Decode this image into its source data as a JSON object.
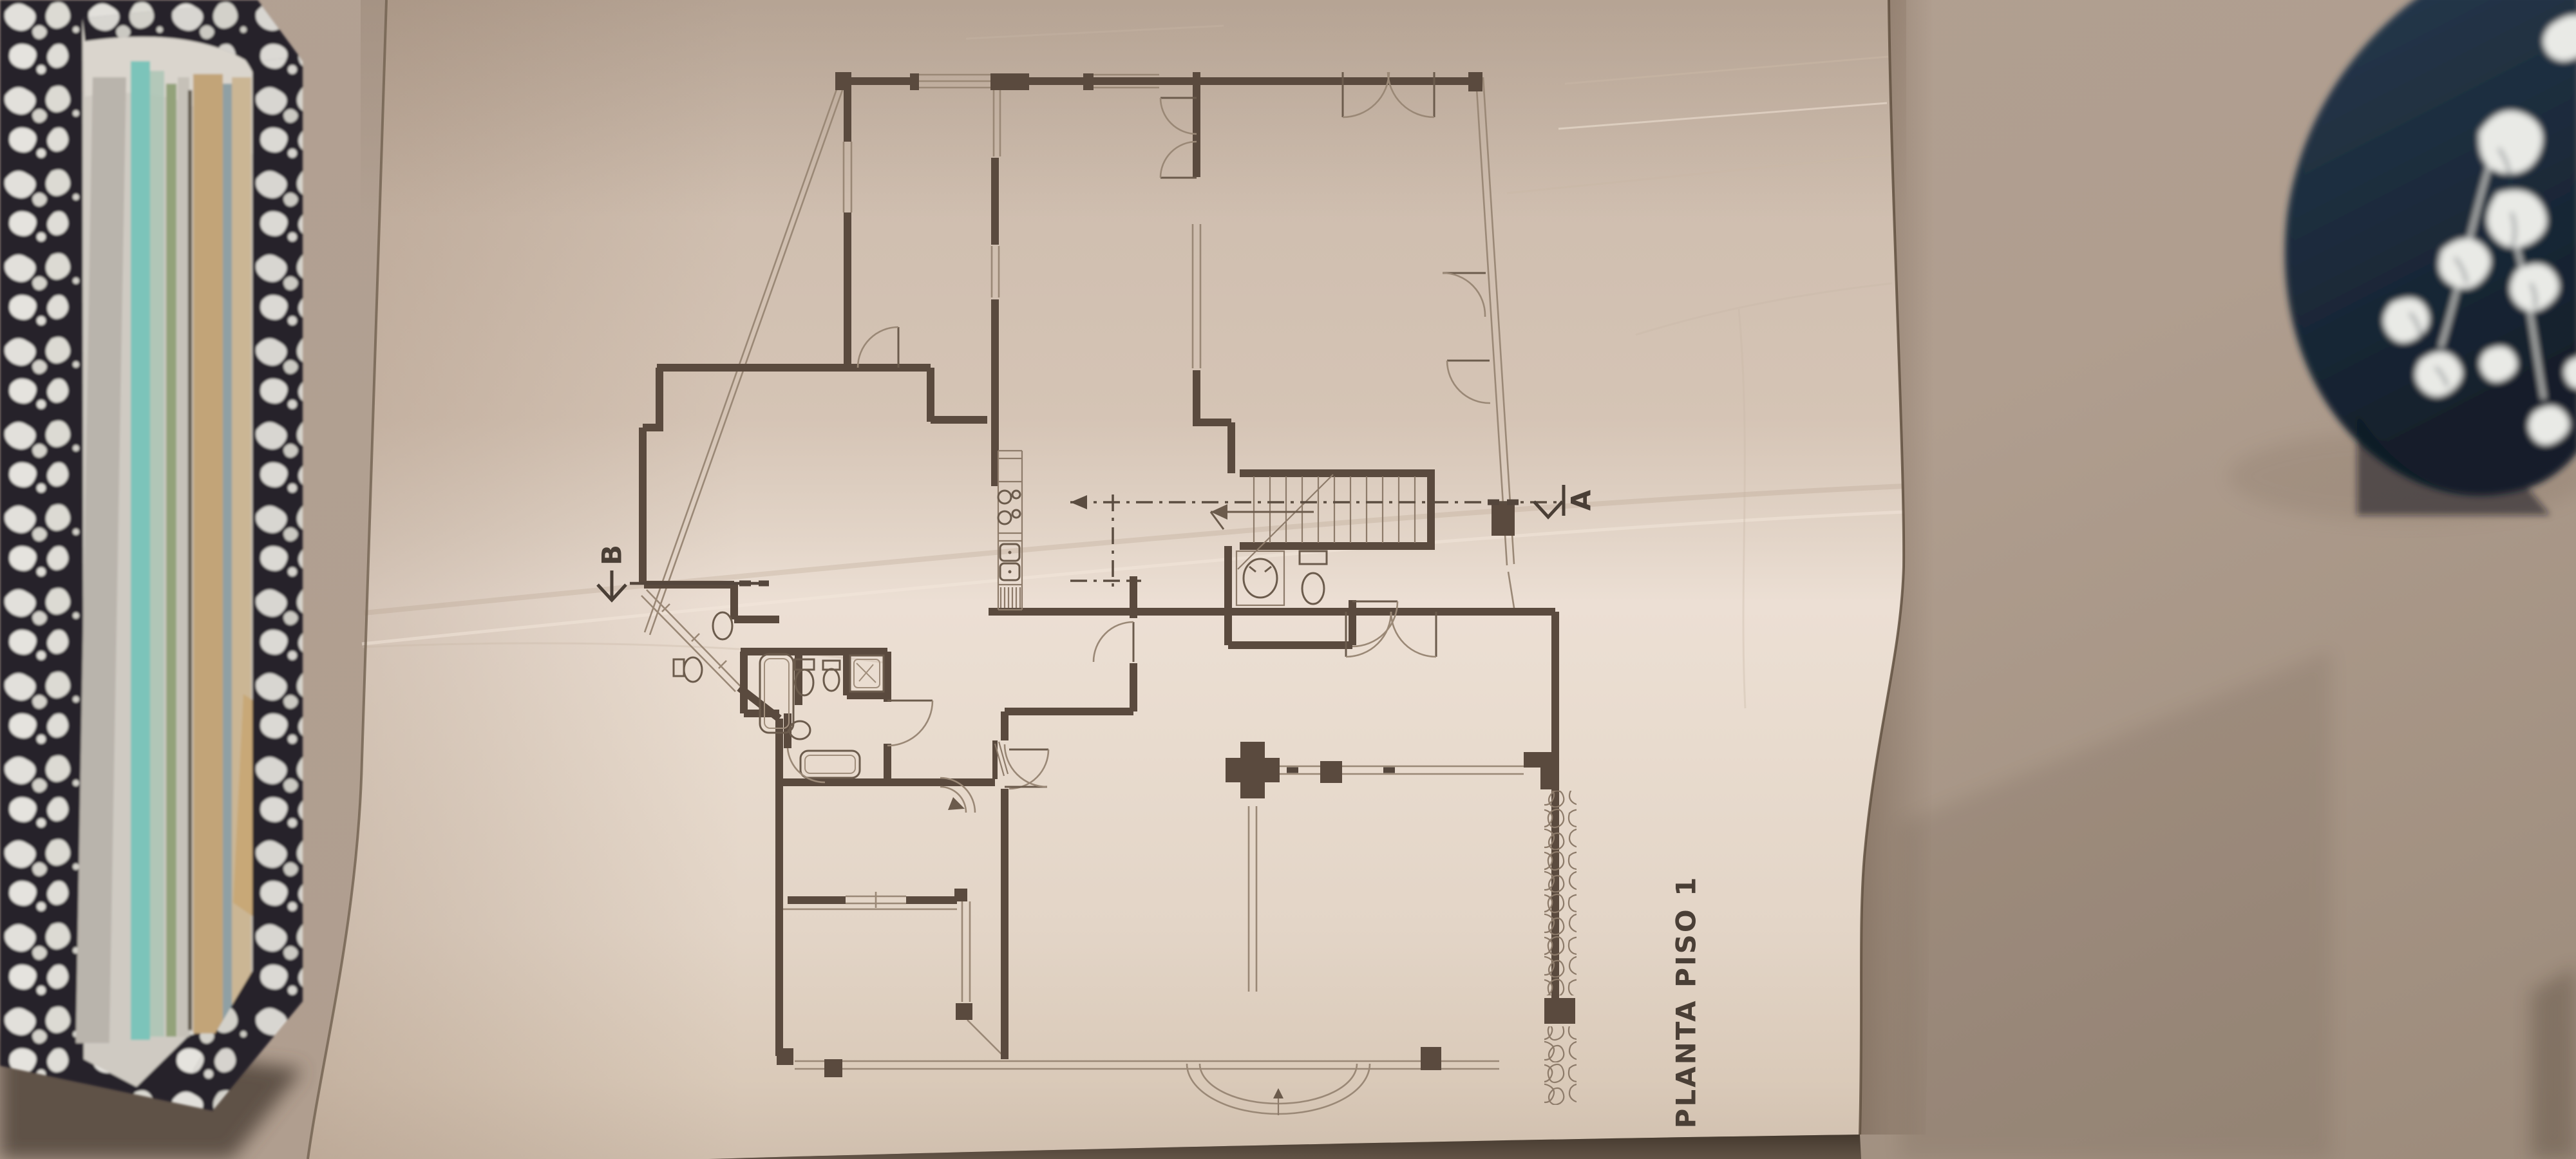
{
  "scene": {
    "blueprint": {
      "title": "PLANTA PISO 1",
      "section_marker_a": "A",
      "section_marker_b": "B"
    },
    "colors": {
      "wall_background": "#b3a294",
      "wall_shadow": "#8f8173",
      "paper_shadow_area": "#cbbaab",
      "paper_bright_fold": "#ecdfd4",
      "plan_ink": "#5a4a3e",
      "plan_pencil": "#9a8876",
      "notebook_cover": "#26232a",
      "notebook_fleck": "#eceae4",
      "page_edge_teal": "#7cc4ba",
      "page_edge_tan": "#c2a478",
      "page_edge_olive": "#93a27a",
      "manila_folder": "#c8a877",
      "fabric_navy": "#1d2c3c",
      "fabric_floral_white": "#e9eae6"
    },
    "objects": {
      "left": "stacked-notebooks-with-papers",
      "center": "folded-blueprint-sheet-with-floor-plan",
      "right": "floral-upholstery-chair-corner"
    }
  }
}
